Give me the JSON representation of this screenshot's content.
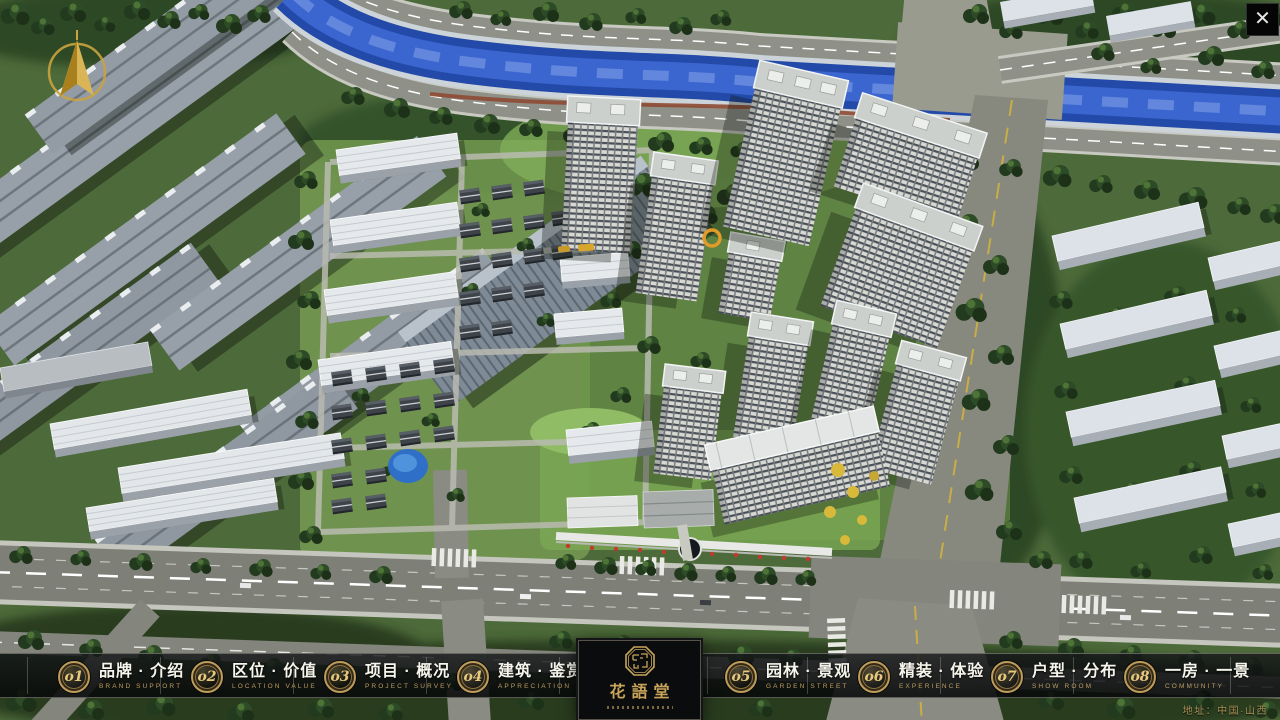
{
  "ui": {
    "close_glyph": "✕"
  },
  "nav": {
    "items": [
      {
        "num": "o1",
        "label": "品牌 · 介绍",
        "sub": "BRAND SUPPORT"
      },
      {
        "num": "o2",
        "label": "区位 · 价值",
        "sub": "LOCATION VALUE"
      },
      {
        "num": "o3",
        "label": "项目 · 概况",
        "sub": "PROJECT SURVEY"
      },
      {
        "num": "o4",
        "label": "建筑 · 鉴赏",
        "sub": "APPRECIATION"
      },
      {
        "num": "o5",
        "label": "园林 · 景观",
        "sub": "GARDEN STREET"
      },
      {
        "num": "o6",
        "label": "精装 · 体验",
        "sub": "EXPERIENCE"
      },
      {
        "num": "o7",
        "label": "户型 · 分布",
        "sub": "SHOW ROOM"
      },
      {
        "num": "o8",
        "label": "一房 · 一景",
        "sub": "COMMUNITY"
      }
    ]
  },
  "logo": {
    "title": "花語堂"
  },
  "footer": {
    "address": "地址：中国·山西"
  },
  "colors": {
    "accent_gold": "#c9a55a",
    "bar_background": "rgba(10,12,14,0.85)",
    "river_blue": "#2a52bb",
    "tree_green": "#2d4b26",
    "road_grey": "#84857c",
    "tower_white": "#d9dad3"
  }
}
